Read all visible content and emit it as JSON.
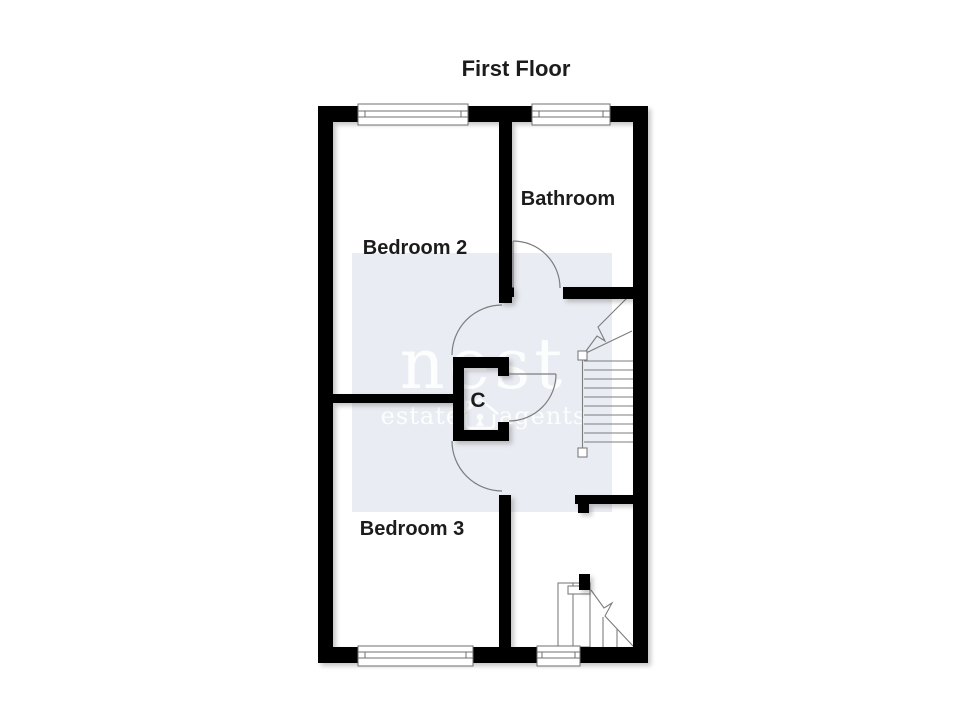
{
  "title": "First Floor",
  "rooms": {
    "bedroom2": "Bedroom 2",
    "bathroom": "Bathroom",
    "bedroom3": "Bedroom 3",
    "closet": "C"
  },
  "watermark": {
    "brand": "nest",
    "tagline_left": "estate",
    "tagline_right": "agents",
    "panel_color": "#e9ecf2",
    "text_color": "#ffffff"
  },
  "colors": {
    "wall": "#000000",
    "line": "#7d7d7d",
    "label": "#1c1c1c",
    "window_fill": "#ffffff",
    "background": "#ffffff"
  }
}
